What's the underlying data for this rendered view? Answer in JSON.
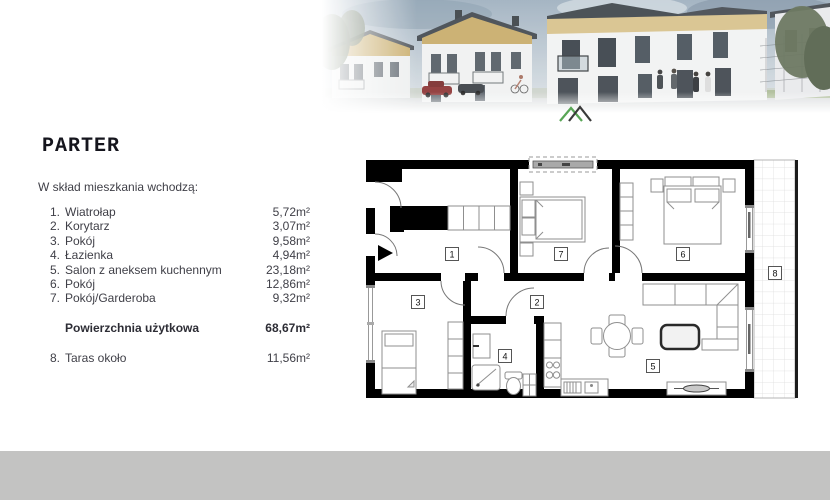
{
  "document": {
    "title": "PARTER",
    "intro": "W skład mieszkania wchodzą:"
  },
  "rooms": [
    {
      "no": "1.",
      "label": "Wiatrołap",
      "area": "5,72m²"
    },
    {
      "no": "2.",
      "label": "Korytarz",
      "area": "3,07m²"
    },
    {
      "no": "3.",
      "label": "Pokój",
      "area": "9,58m²"
    },
    {
      "no": "4.",
      "label": "Łazienka",
      "area": "4,94m²"
    },
    {
      "no": "5.",
      "label": "Salon z aneksem kuchennym",
      "area": "23,18m²"
    },
    {
      "no": "6.",
      "label": "Pokój",
      "area": "12,86m²"
    },
    {
      "no": "7.",
      "label": "Pokój/Garderoba",
      "area": "9,32m²"
    }
  ],
  "summary": {
    "label": "Powierzchnia użytkowa",
    "area": "68,67m²"
  },
  "terrace": {
    "no": "8.",
    "label": "Taras około",
    "area": "11,56m²"
  },
  "floorplan": {
    "labels": [
      "1",
      "2",
      "3",
      "4",
      "5",
      "6",
      "7",
      "8"
    ]
  },
  "colors": {
    "accent_green": "#58a555",
    "logo_dark": "#3a3a3a",
    "footer_gray": "#c3c3c2",
    "wall_black": "#000000",
    "body_text": "#3f3f47",
    "title_text": "#15151d"
  }
}
